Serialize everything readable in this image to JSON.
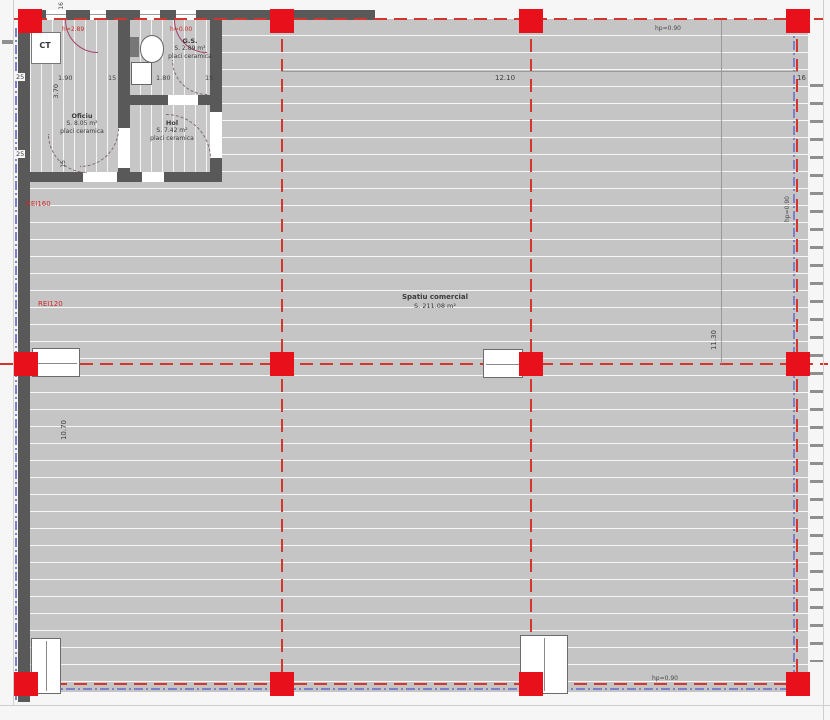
{
  "colors": {
    "column_red": "#e8101a",
    "axis_red": "#d5352c",
    "slab_blue": "#7b80c8",
    "wall_gray": "#595959",
    "floor_gray": "#c5c5c5"
  },
  "rooms": {
    "ct": {
      "label": "CT"
    },
    "oficiu": {
      "name": "Oficiu",
      "area": "S. 8.05 m²",
      "finish": "placi ceramica"
    },
    "gs": {
      "name": "G.S.",
      "area": "S. 2.89 m²",
      "finish": "placi ceramica"
    },
    "hol": {
      "name": "Hol",
      "area": "S. 7.42 m²",
      "finish": "placi ceramica"
    },
    "commercial": {
      "name": "Spatiu comercial",
      "area": "S. 211.08 m²"
    }
  },
  "dimensions": {
    "wall_left_top": "25",
    "wall_left_mid": "25",
    "oficiu_width": "1.90",
    "partition_a": "15",
    "gs_width": "1.80",
    "partition_b": "15",
    "oficiu_height": "3.70",
    "window_top": "16",
    "door_bottom": "15",
    "bay_width": "12.10",
    "bay_edge": "16",
    "bay_height_right": "11.30",
    "hall_height_left": "10.70"
  },
  "annotations": {
    "fire_wall_upper": "REI160",
    "fire_wall_lower": "REI120",
    "window_height_left": "h=2.89",
    "window_height_right": "h=0.00",
    "parapet_top": "hp=0.90",
    "parapet_right": "hp=0.90",
    "parapet_bottom": "hp=0.90"
  }
}
